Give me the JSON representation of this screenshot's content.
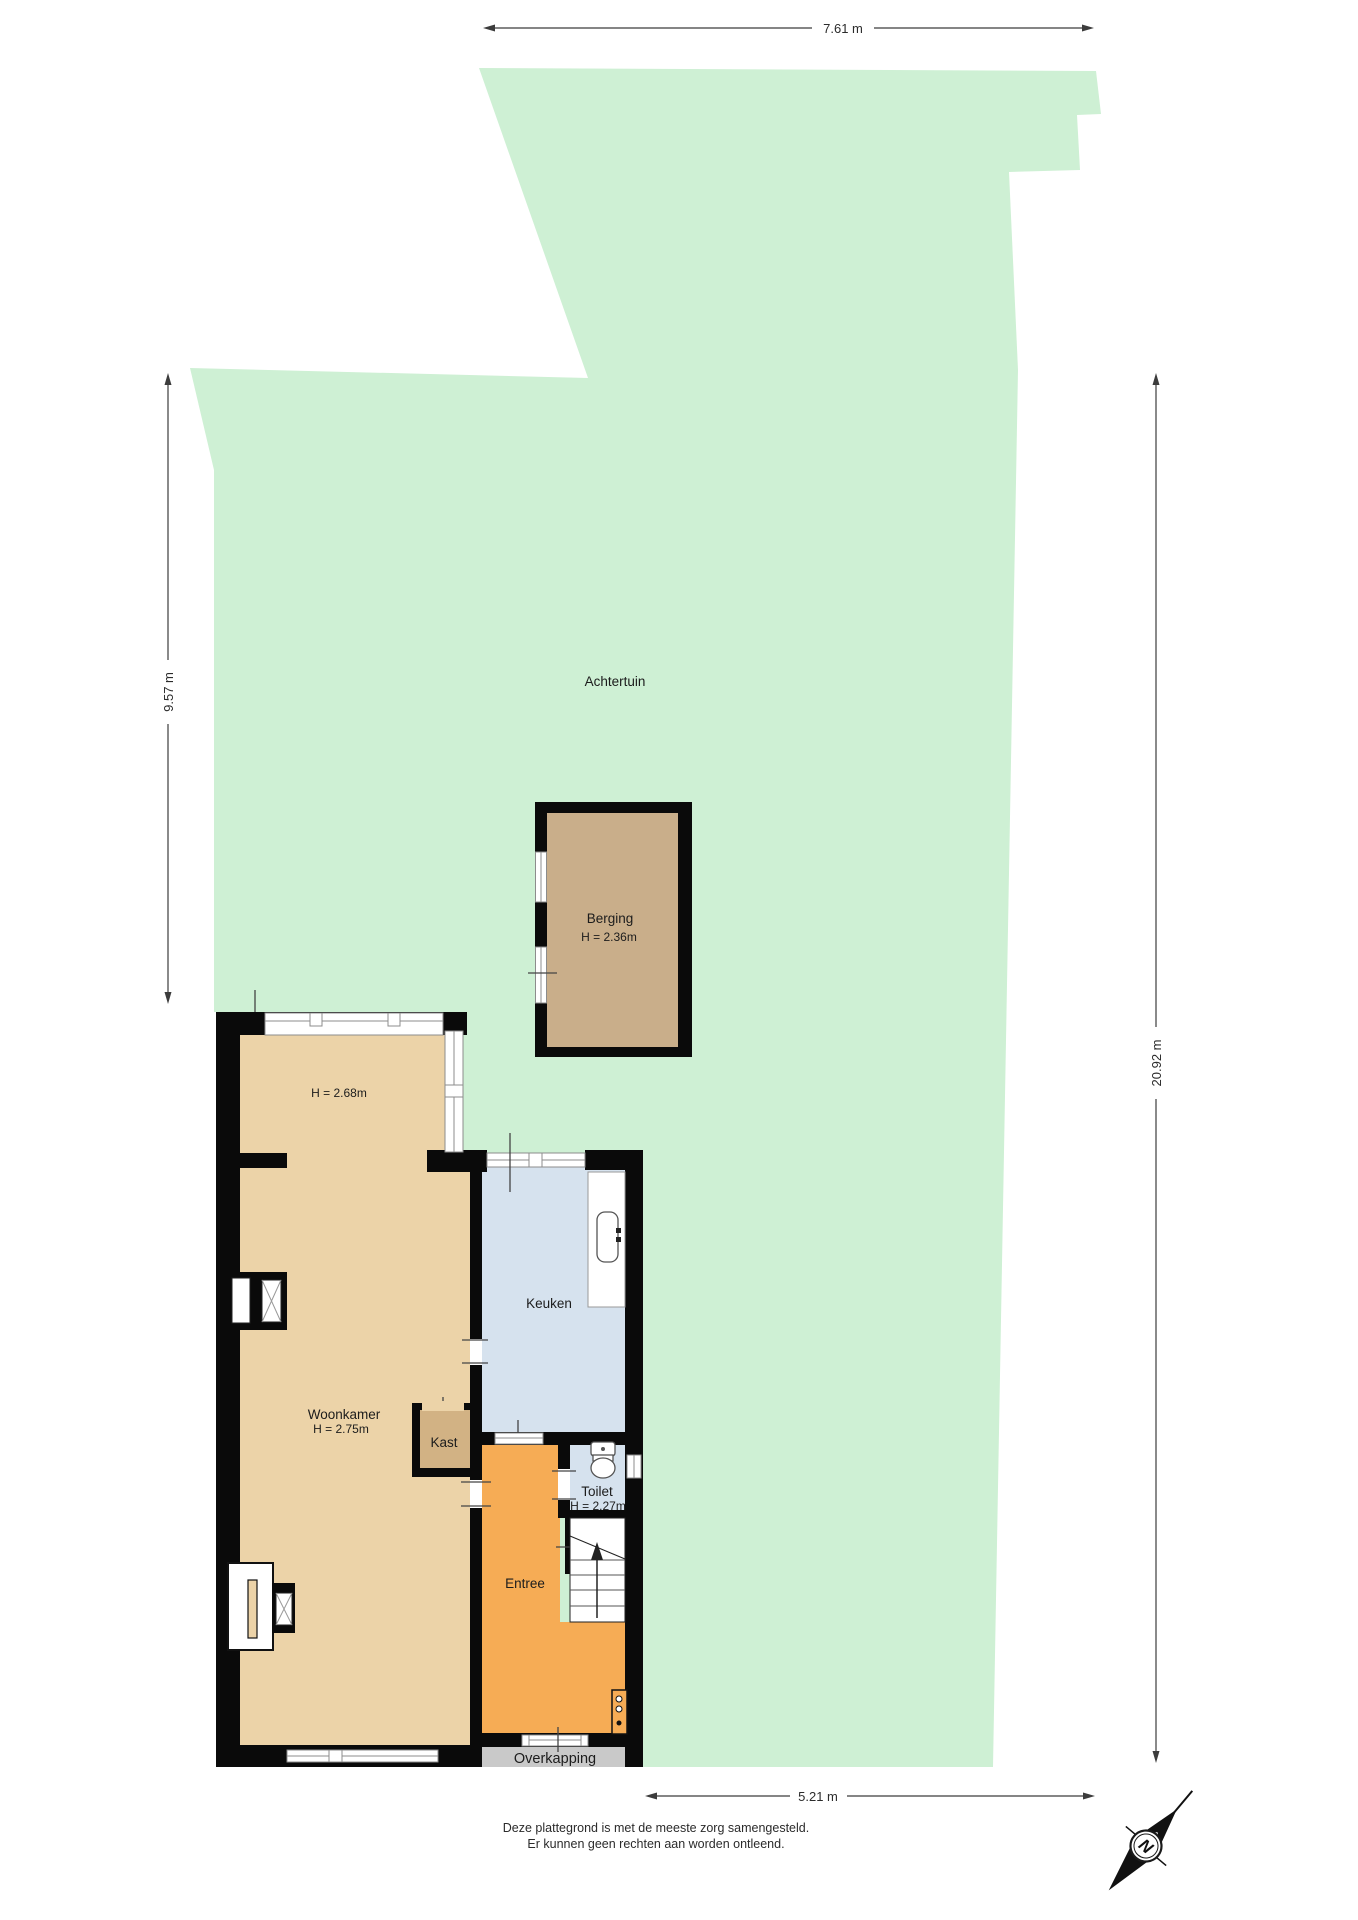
{
  "rooms": {
    "achtertuin": {
      "label": "Achtertuin"
    },
    "berging": {
      "label": "Berging",
      "height": "H = 2.36m"
    },
    "uitbouw": {
      "height": "H = 2.68m"
    },
    "keuken": {
      "label": "Keuken"
    },
    "woonkamer": {
      "label": "Woonkamer",
      "height": "H = 2.75m"
    },
    "kast": {
      "label": "Kast"
    },
    "toilet": {
      "label": "Toilet",
      "height": "H = 2.27m"
    },
    "entree": {
      "label": "Entree"
    },
    "overkapping": {
      "label": "Overkapping"
    }
  },
  "dimensions": {
    "top": "7.61 m",
    "left": "9.57 m",
    "right": "20.92 m",
    "bottom": "5.21 m"
  },
  "compass": {
    "label": "N"
  },
  "disclaimer": {
    "line1": "Deze plattegrond is met de meeste zorg samengesteld.",
    "line2": "Er kunnen geen rechten aan worden ontleend."
  },
  "colors": {
    "garden": "#CEF0D4",
    "living_room": "#ECD3A8",
    "closet": "#D2B284",
    "storage": "#C9AE8A",
    "kitchen_toilet": "#D6E2EE",
    "hall": "#F6AC55",
    "canopy": "#C9C9C9",
    "wall": "#0A0A0A"
  }
}
